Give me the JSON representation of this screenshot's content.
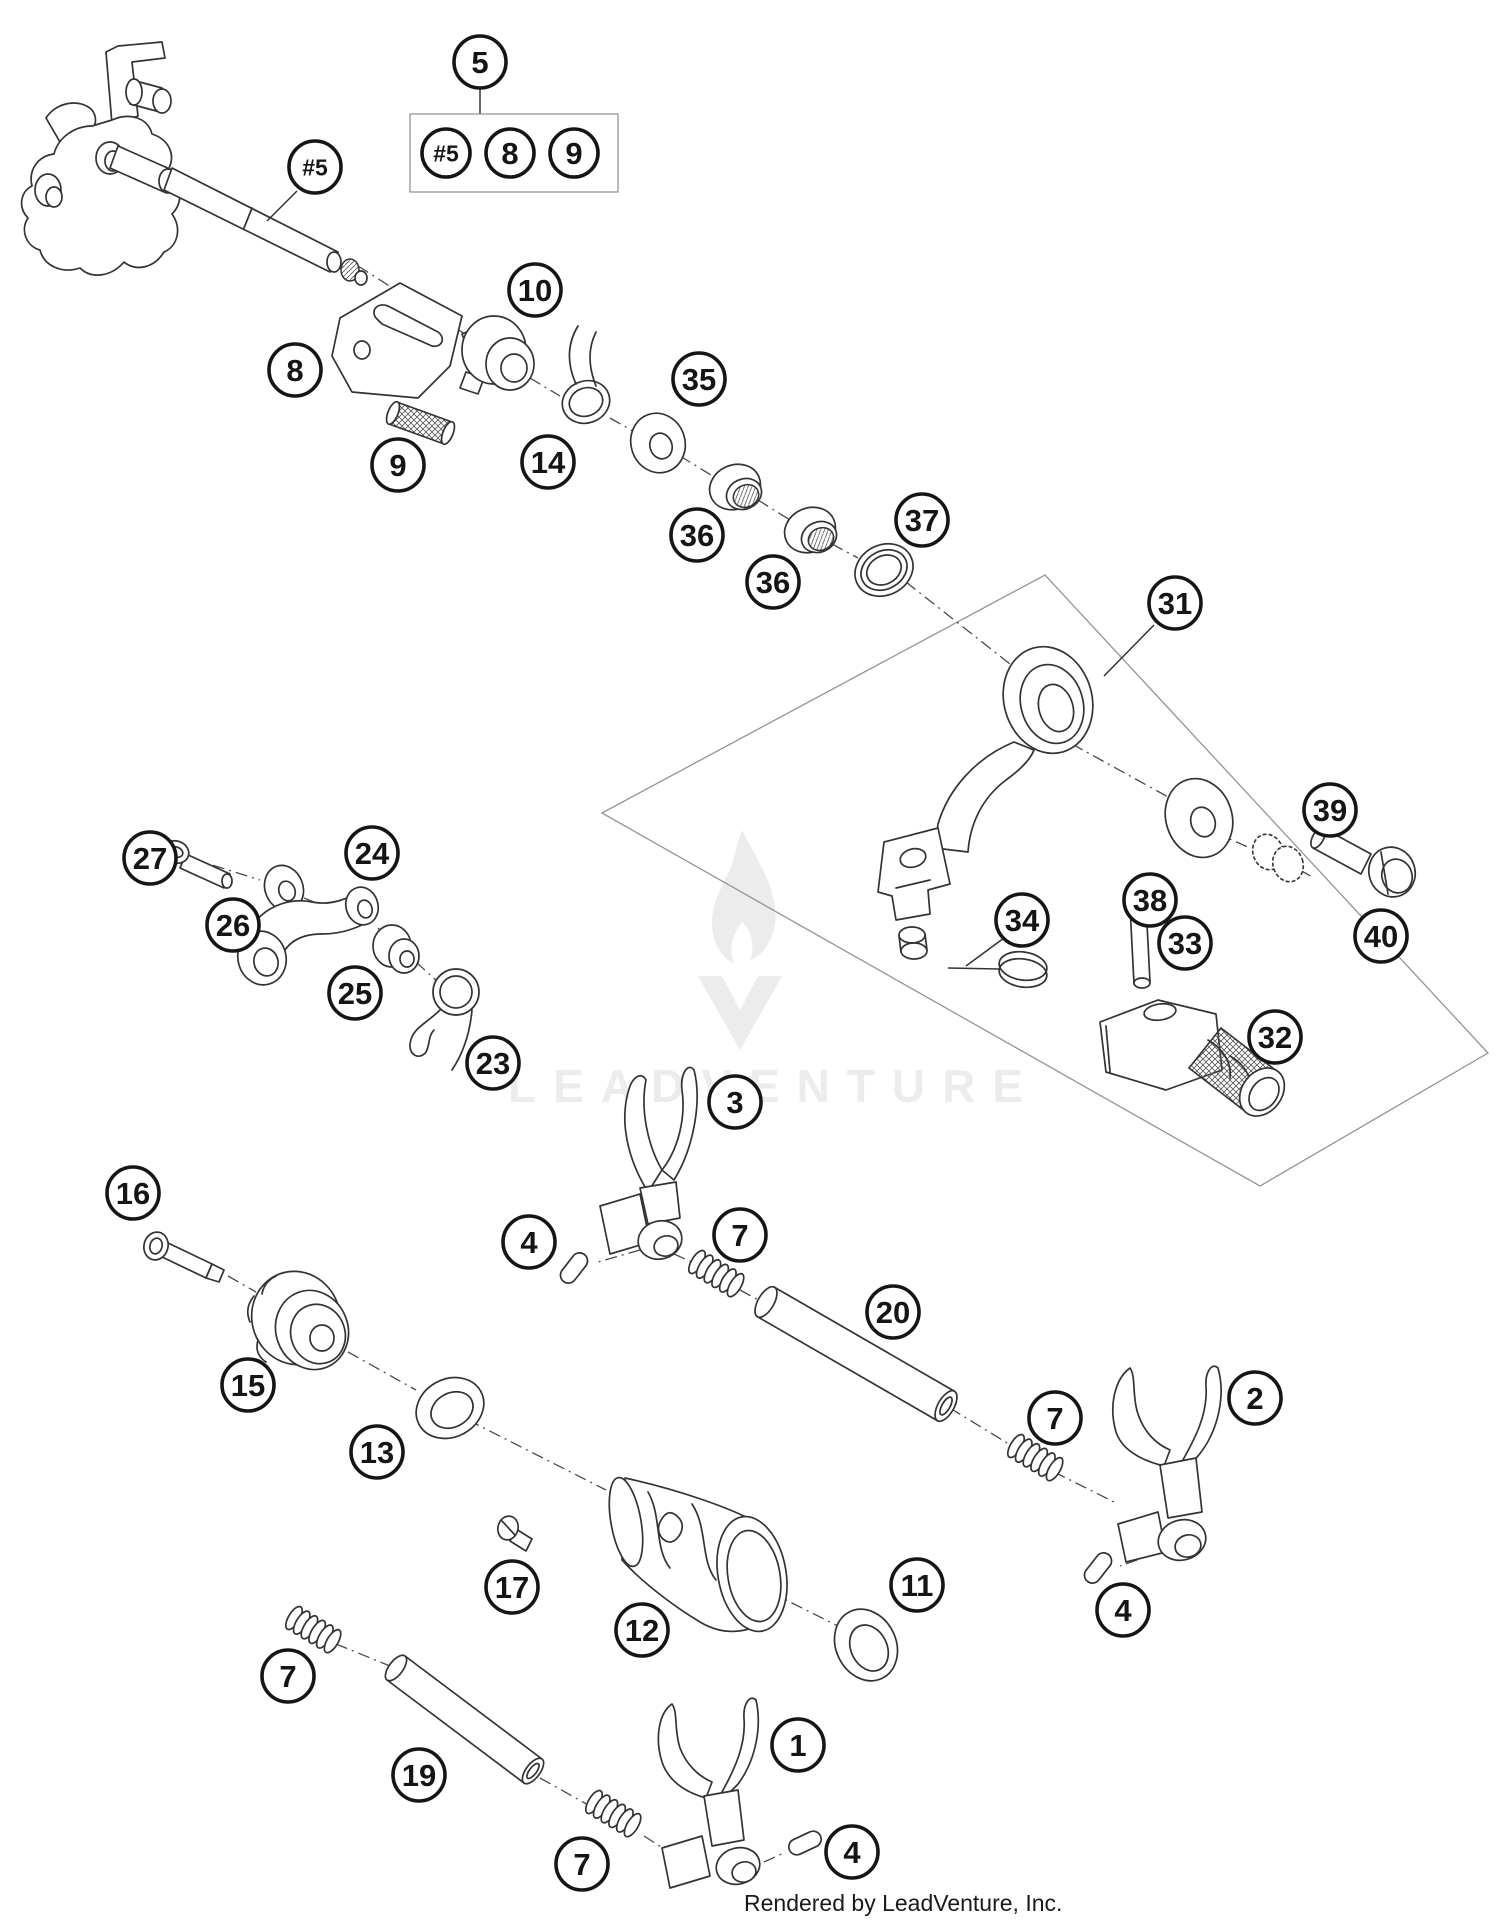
{
  "page": {
    "background": "#ffffff",
    "footer_text": "Rendered by LeadVenture, Inc.",
    "line_color": "#333333"
  },
  "watermark": {
    "text": "LEADVENTURE",
    "color": "#ececec",
    "logo": "leadventure-flame-v-logo"
  },
  "legend": {
    "parent_label": "5",
    "items": [
      "#5",
      "8",
      "9"
    ]
  },
  "callout_style": {
    "radius": 26,
    "stroke": "#151515",
    "fill": "#ffffff"
  },
  "callouts": [
    {
      "label": "5",
      "x": 480,
      "y": 62
    },
    {
      "label": "#5",
      "x": 446,
      "y": 153,
      "r": 24,
      "small": true
    },
    {
      "label": "8",
      "x": 510,
      "y": 153,
      "r": 24
    },
    {
      "label": "9",
      "x": 574,
      "y": 153,
      "r": 24
    },
    {
      "label": "#5",
      "x": 315,
      "y": 167,
      "small": true
    },
    {
      "label": "8",
      "x": 295,
      "y": 370
    },
    {
      "label": "9",
      "x": 398,
      "y": 465
    },
    {
      "label": "10",
      "x": 535,
      "y": 290
    },
    {
      "label": "14",
      "x": 548,
      "y": 462
    },
    {
      "label": "35",
      "x": 699,
      "y": 379
    },
    {
      "label": "36",
      "x": 697,
      "y": 535
    },
    {
      "label": "36",
      "x": 773,
      "y": 582
    },
    {
      "label": "37",
      "x": 922,
      "y": 520
    },
    {
      "label": "31",
      "x": 1175,
      "y": 603
    },
    {
      "label": "38",
      "x": 1150,
      "y": 900
    },
    {
      "label": "39",
      "x": 1330,
      "y": 810
    },
    {
      "label": "40",
      "x": 1381,
      "y": 936
    },
    {
      "label": "27",
      "x": 150,
      "y": 858
    },
    {
      "label": "24",
      "x": 372,
      "y": 853
    },
    {
      "label": "26",
      "x": 233,
      "y": 925
    },
    {
      "label": "25",
      "x": 355,
      "y": 993
    },
    {
      "label": "23",
      "x": 493,
      "y": 1063
    },
    {
      "label": "34",
      "x": 1022,
      "y": 920
    },
    {
      "label": "33",
      "x": 1185,
      "y": 943
    },
    {
      "label": "32",
      "x": 1275,
      "y": 1037
    },
    {
      "label": "3",
      "x": 735,
      "y": 1102
    },
    {
      "label": "4",
      "x": 529,
      "y": 1242
    },
    {
      "label": "7",
      "x": 740,
      "y": 1235
    },
    {
      "label": "20",
      "x": 893,
      "y": 1312
    },
    {
      "label": "16",
      "x": 133,
      "y": 1193
    },
    {
      "label": "15",
      "x": 248,
      "y": 1385
    },
    {
      "label": "13",
      "x": 377,
      "y": 1452
    },
    {
      "label": "17",
      "x": 512,
      "y": 1587
    },
    {
      "label": "12",
      "x": 642,
      "y": 1630
    },
    {
      "label": "11",
      "x": 917,
      "y": 1585
    },
    {
      "label": "7",
      "x": 1055,
      "y": 1418
    },
    {
      "label": "2",
      "x": 1255,
      "y": 1398
    },
    {
      "label": "4",
      "x": 1123,
      "y": 1610
    },
    {
      "label": "7",
      "x": 288,
      "y": 1676
    },
    {
      "label": "19",
      "x": 419,
      "y": 1775
    },
    {
      "label": "7",
      "x": 582,
      "y": 1864
    },
    {
      "label": "1",
      "x": 798,
      "y": 1745
    },
    {
      "label": "4",
      "x": 852,
      "y": 1852
    }
  ]
}
